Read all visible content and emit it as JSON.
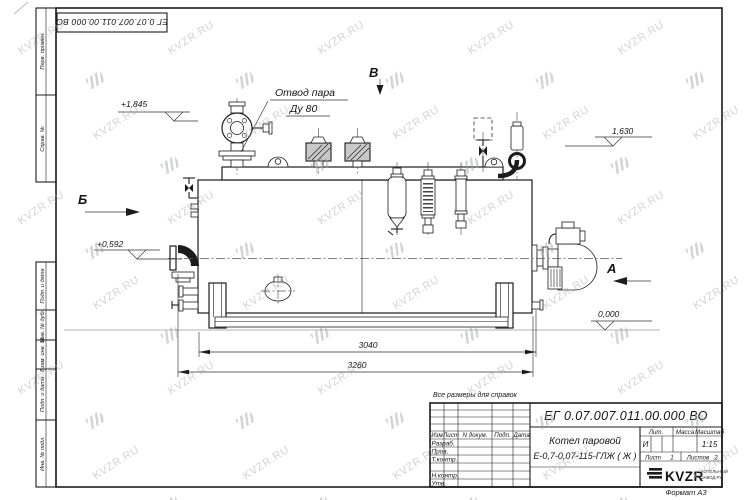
{
  "sheet": {
    "stamp_top_left": "ЕГ 0.07.007.011.00.000  ВО",
    "note": "Все размеры для справок",
    "format_label": "Формат А3",
    "margin_labels_top": [
      "Перв. примен.",
      "Справ. №"
    ],
    "margin_labels_bottom": [
      "Подп. и дата",
      "Инв. № дубл.",
      "Взам. инв. №",
      "Подп. и дата",
      "Инв. № подл."
    ]
  },
  "drawing": {
    "callout": {
      "line1": "Отвод пара",
      "line2": "Ду 80"
    },
    "view_markers": {
      "b": "Б",
      "v": "В",
      "a": "А"
    },
    "elevations": {
      "e1": "+1,845",
      "e2": "+0,592",
      "e3": "1,630",
      "e4": "0,000"
    },
    "dimensions": {
      "d1": "3040",
      "d2": "3260"
    }
  },
  "title_block": {
    "doc_number": "ЕГ 0.07.007.011.00.000  ВО",
    "title_line1": "Котел паровой",
    "title_line2": "Е-0,7-0,07-115-ГЛЖ ( Ж )",
    "headers": {
      "izm": "Изм",
      "list": "Лист",
      "n_dokum": "N докум.",
      "podp": "Подп.",
      "data": "Дата"
    },
    "rows": [
      "Разраб.",
      "Пров.",
      "Т.контр.",
      "Н.контр.",
      "Утв."
    ],
    "lit_header": "Лит.",
    "massa_header": "Масса",
    "masshtab_header": "Масштаб",
    "lit_value": "И",
    "scale_value": "1:15",
    "sheet_label": "Лист",
    "sheet_value": "1",
    "sheets_label": "Листов",
    "sheets_value": "2",
    "logo_text": "KVZR",
    "logo_sub1": "КОТЕЛЬНЫЙ",
    "logo_sub2": "ЗАВОД.РУ"
  },
  "watermark": {
    "text": "KVZR.RU"
  }
}
